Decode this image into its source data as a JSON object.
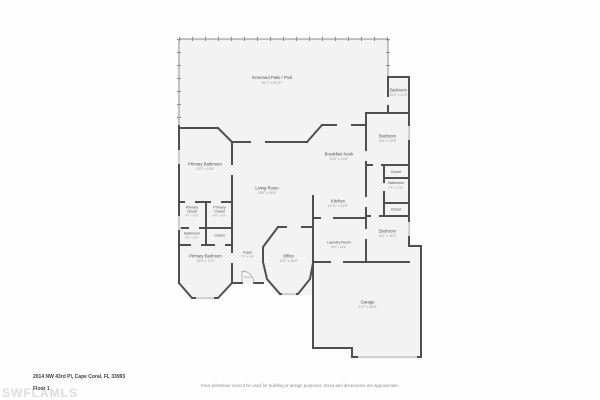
{
  "floorplan": {
    "rooms": {
      "screened_patio": {
        "name": "Screened Patio / Pool",
        "dims": "51'7\" x 21'11\""
      },
      "bedroom_top_right": {
        "name": "Bedroom",
        "dims": "10'1\" x 11'5\""
      },
      "bedroom_right": {
        "name": "Bedroom",
        "dims": "11'5\" x 12'9\""
      },
      "breakfast_nook": {
        "name": "Breakfast Nook",
        "dims": "10'0\" x 10'8\""
      },
      "primary_bathroom": {
        "name": "Primary Bathroom",
        "dims": "13'2\" x 15'9\""
      },
      "living_room": {
        "name": "Living Room",
        "dims": "18'9\" x 24'8\""
      },
      "kitchen": {
        "name": "Kitchen",
        "dims": "12'11\" x 12'5\""
      },
      "closet_right_1": {
        "name": "Closet"
      },
      "bathroom_right": {
        "name": "Bathroom",
        "dims": "6'5\" x 9'11\""
      },
      "closet_right_2": {
        "name": "Closet"
      },
      "primary_closet_left": {
        "line1": "Primary",
        "line2": "Closet",
        "dims": "4'7\" x 6'5\""
      },
      "primary_closet_right": {
        "line1": "Primary",
        "line2": "Closet",
        "dims": "4'9\" x 6'5\""
      },
      "bathroom_left": {
        "name": "Bathroom",
        "dims": "6'5\" x 4'1\""
      },
      "closet_left": {
        "name": "Closet"
      },
      "primary_bedroom": {
        "name": "Primary Bedroom",
        "dims": "13'4\" x 17'1\""
      },
      "foyer": {
        "name": "Foyer",
        "dims": "7'6\" x 9'5\""
      },
      "entry": {
        "name": "Entry"
      },
      "office": {
        "name": "Office",
        "dims": "12'2\" x 15'9\""
      },
      "laundry_room": {
        "name": "Laundry Room",
        "dims": "8'5\" x 10'6\""
      },
      "bedroom_bottom_right": {
        "name": "Bedroom",
        "dims": "11'1\" x 11'5\""
      },
      "garage": {
        "name": "Garage",
        "dims": "21'7\" x 26'5\""
      }
    },
    "colors": {
      "wall": "#4f4f4f",
      "floor": "#f3f3f3",
      "label": "#4f4f4f",
      "dims": "#949494"
    }
  },
  "footer": {
    "address": "2014 NW 43rd Pl, Cape Coral, FL 33993",
    "floor_label": "Floor 1",
    "watermark": "SWFLAMLS",
    "disclaimer": "Floor plans/tour cannot be used for building or design purposes. Sizes and dimensions are approximate."
  }
}
